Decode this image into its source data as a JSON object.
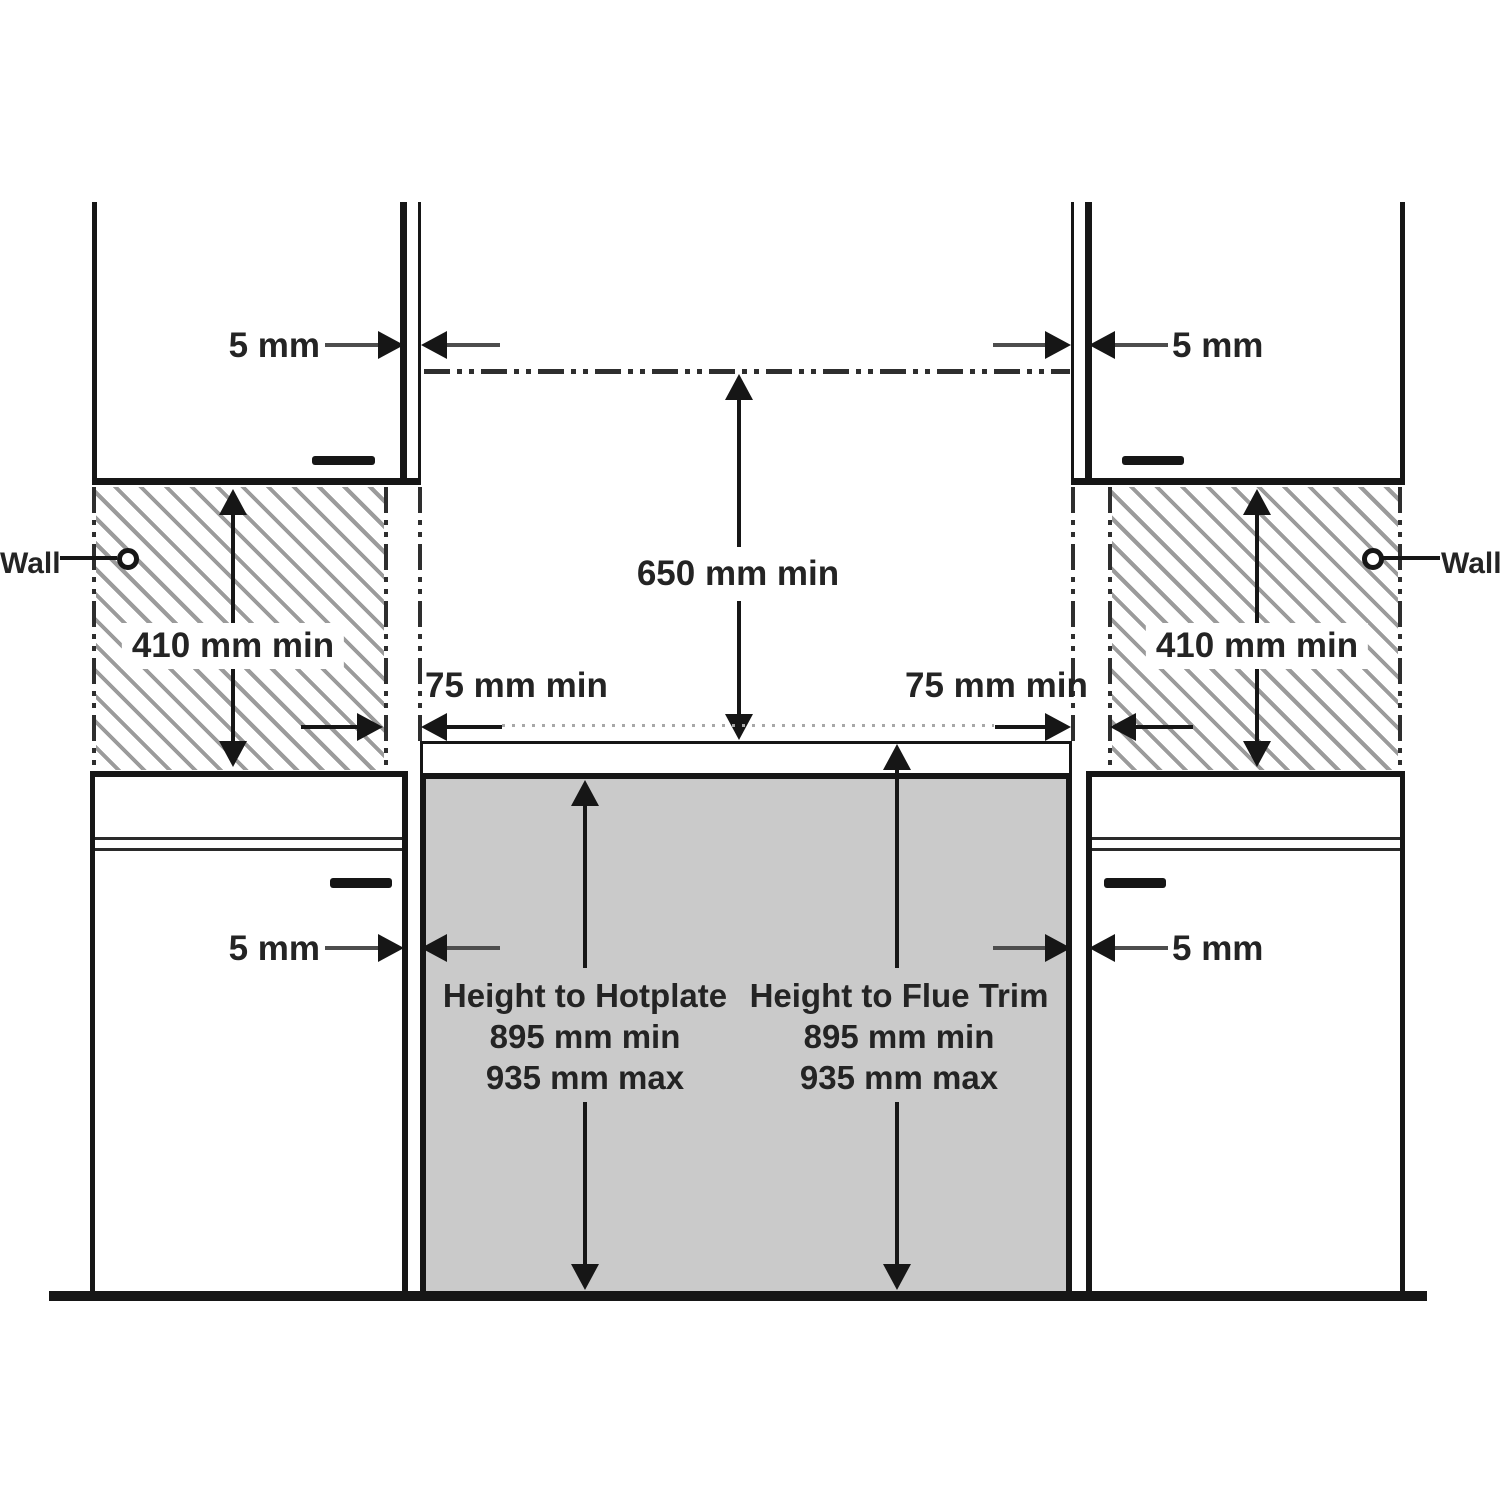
{
  "labels": {
    "wall_left": "Wall",
    "wall_right": "Wall",
    "gap_upper_left": "5 mm",
    "gap_upper_right": "5 mm",
    "gap_lower_left": "5 mm",
    "gap_lower_right": "5 mm",
    "hood_clearance": "650 mm min",
    "wall_height_left": "410 mm min",
    "wall_height_right": "410 mm min",
    "side_extension_left": "75 mm min",
    "side_extension_right": "75 mm min"
  },
  "height_to_hotplate": {
    "title": "Height to Hotplate",
    "min": "895 mm min",
    "max": "935 mm max"
  },
  "height_to_flue_trim": {
    "title": "Height to Flue Trim",
    "min": "895 mm min",
    "max": "935 mm max"
  },
  "colors": {
    "background": "#ffffff",
    "line": "#161616",
    "cooker_fill": "#cacaca",
    "hatch_stroke": "#9b9b9b",
    "dimension_shaft": "#4d4d4d",
    "text": "#242424"
  }
}
